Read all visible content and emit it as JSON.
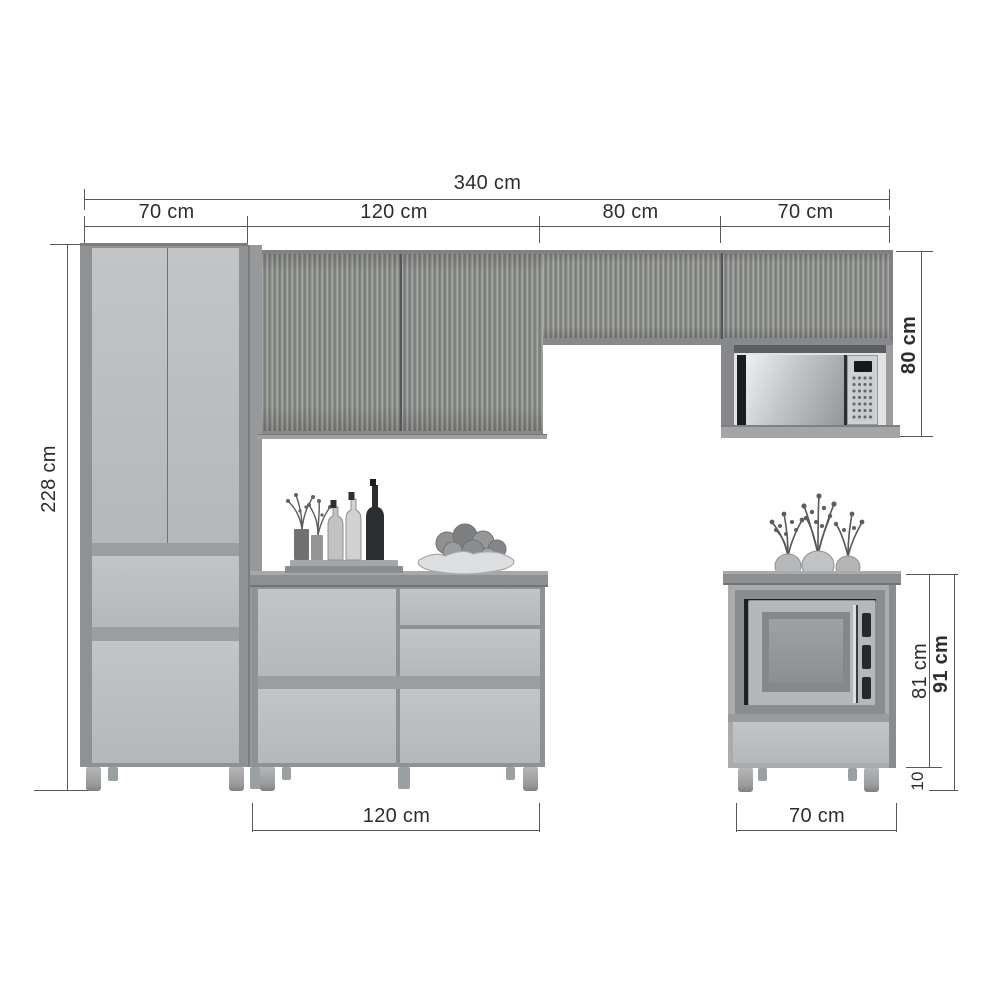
{
  "meta": {
    "title": "Modular kitchen cabinet set — dimension diagram",
    "style": "grayscale 3D furniture line drawing with dimension annotations"
  },
  "dimensions": {
    "total_width": "340 cm",
    "segments": [
      {
        "label": "70 cm"
      },
      {
        "label": "120 cm"
      },
      {
        "label": "80 cm"
      },
      {
        "label": "70 cm"
      }
    ],
    "tall_cabinet_height": "228 cm",
    "upper_cabinet_height": "80 cm",
    "base_cabinet_width": "120 cm",
    "microwave_cabinet_width": "70 cm",
    "microwave_cabinet_body_height": "81 cm",
    "microwave_cabinet_total_height": "91 cm",
    "leg_height": "10"
  },
  "objects": {
    "tall_cabinet": "two-door pantry cabinet with two drawers",
    "upper_cabinets": "slatted wall cabinets with microwave niche",
    "base_cabinet": "counter cabinet with doors and drawers",
    "right_cabinet": "floor microwave cabinet with drawer",
    "decor": [
      "tray with vases and bottles",
      "fruit bowl",
      "three potted plants",
      "two microwaves"
    ]
  },
  "colors": {
    "background": "#ffffff",
    "door_front": "#bcbec0",
    "carcass": "#8f9193",
    "slat_texture": "#90928f",
    "countertop": "#8e9092",
    "dimension_line": "#55575a",
    "dimension_text": "#2b2d2f",
    "microwave_dark": "#1e1f21"
  }
}
